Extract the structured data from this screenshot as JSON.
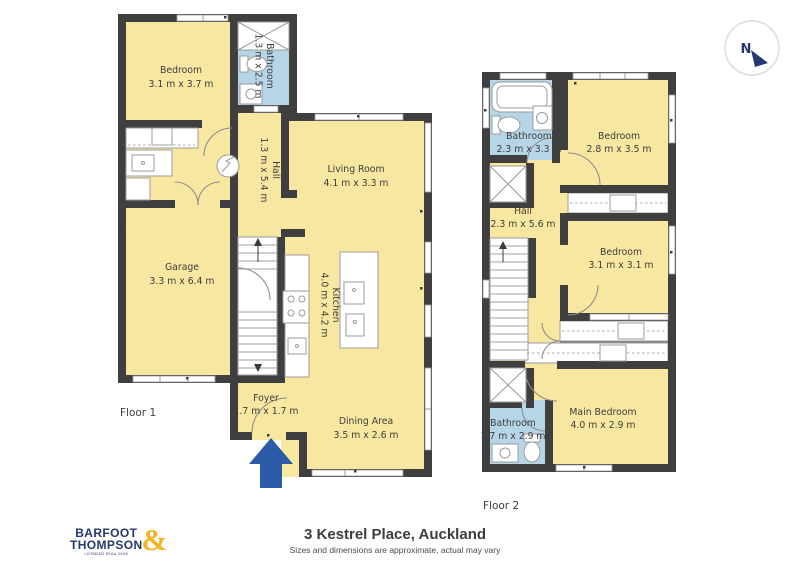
{
  "address_block": {
    "title": "3 Kestrel Place, Auckland",
    "disclaimer": "Sizes and dimensions are approximate, actual may vary"
  },
  "logo": {
    "line1": "BARFOOT",
    "line2": "THOMPSON",
    "ampersand": "&",
    "tagline": "LICENSED REAA 2008"
  },
  "compass": {
    "n": "N"
  },
  "floor1": {
    "label": "Floor 1",
    "rooms": [
      {
        "name": "Bedroom",
        "dims": "3.1 m x 3.7 m"
      },
      {
        "name": "Bathroom",
        "dims": "1.3 m x 2.5 m"
      },
      {
        "name": "Hall",
        "dims": "1.3 m x 5.4 m"
      },
      {
        "name": "Living Room",
        "dims": "4.1 m x 3.3 m"
      },
      {
        "name": "Garage",
        "dims": "3.3 m x 6.4 m"
      },
      {
        "name": "Kitchen",
        "dims": "4.0 m x 4.2 m"
      },
      {
        "name": "Foyer",
        "dims": "1.7 m x 1.7 m"
      },
      {
        "name": "Dining Area",
        "dims": "3.5 m x 2.6 m"
      }
    ]
  },
  "floor2": {
    "label": "Floor 2",
    "rooms": [
      {
        "name": "Bathroom",
        "dims": "2.3 m x 3.3 m"
      },
      {
        "name": "Bedroom",
        "dims": "2.8 m x 3.5 m"
      },
      {
        "name": "Hall",
        "dims": "2.3 m x 5.6 m"
      },
      {
        "name": "Bedroom",
        "dims": "3.1 m x 3.1 m"
      },
      {
        "name": "Main Bedroom",
        "dims": "4.0 m x 2.9 m"
      },
      {
        "name": "Bathroom",
        "dims": "1.7 m x 2.9 m"
      }
    ]
  },
  "colors": {
    "room_fill": "#f8e7a1",
    "bathroom_fill": "#b6d6e8",
    "wall": "#3f3f3f",
    "brand_navy": "#24376e",
    "brand_gold": "#f2b424",
    "arrow_blue": "#2b5aa7"
  }
}
